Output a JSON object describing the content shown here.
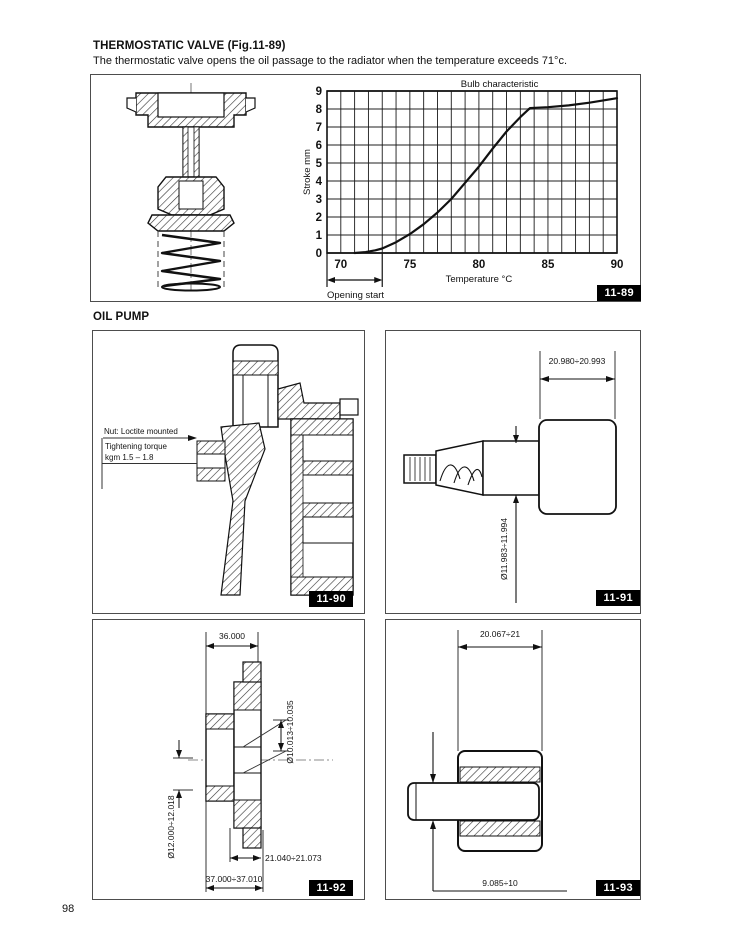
{
  "page": {
    "number": "98"
  },
  "thermostatic": {
    "heading": "THERMOSTATIC VALVE (Fig.11-89)",
    "body": "The thermostatic valve opens the oil passage to the radiator when the temperature exceeds 71°c."
  },
  "oil_pump": {
    "heading": "OIL PUMP"
  },
  "figures": {
    "fig89": {
      "label": "11-89"
    },
    "fig90": {
      "label": "11-90",
      "note_nut": "Nut: Loctite mounted",
      "note_torque1": "Tightening torque",
      "note_torque2": "kgm 1.5 – 1.8"
    },
    "fig91": {
      "label": "11-91",
      "dim_width": "20.980÷20.993",
      "dim_diameter": "Ø11.983÷11.994"
    },
    "fig92": {
      "label": "11-92",
      "dim_top": "36.000",
      "dim_bore_small": "Ø10.013÷10.035",
      "dim_bore_large": "Ø12.000÷12.018",
      "dim_inner": "21.040÷21.073",
      "dim_overall": "37.000÷37.010"
    },
    "fig93": {
      "label": "11-93",
      "dim_width": "20.067÷21",
      "dim_offset": "9.085÷10"
    }
  },
  "chart_data": {
    "type": "line",
    "title": "Bulb characteristic",
    "xlabel": "Temperature °C",
    "ylabel": "Stroke mm",
    "xlim": [
      69,
      90
    ],
    "ylim": [
      0,
      9
    ],
    "x_ticks": [
      70,
      75,
      80,
      85,
      90
    ],
    "y_ticks": [
      0,
      1,
      2,
      3,
      4,
      5,
      6,
      7,
      8,
      9
    ],
    "grid": true,
    "legend": "none",
    "annotation": "Opening start",
    "annotation_range": [
      69,
      73
    ],
    "series": [
      {
        "name": "Bulb characteristic",
        "x": [
          71.0,
          71.8,
          72.5,
          73.0,
          74.0,
          75.0,
          76.0,
          77.0,
          78.0,
          79.0,
          80.0,
          81.0,
          82.0,
          83.0,
          83.7,
          85.0,
          86.5,
          88.0,
          90.0
        ],
        "y": [
          0.0,
          0.05,
          0.15,
          0.25,
          0.6,
          1.05,
          1.6,
          2.25,
          3.0,
          3.9,
          4.8,
          5.8,
          6.75,
          7.55,
          8.05,
          8.1,
          8.2,
          8.35,
          8.6
        ]
      }
    ]
  }
}
